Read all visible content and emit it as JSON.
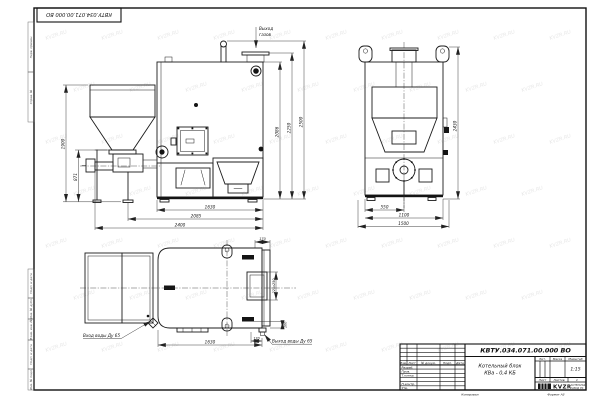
{
  "page": {
    "watermark": "KVZR.RU"
  },
  "corner_stamp": {
    "doc_number": "КВТУ.034.071.00.000 ВО"
  },
  "margin_labels": [
    "Перв. примен.",
    "Справ. №",
    "Подп. и дата",
    "Инв. № дубл.",
    "Взам. инв. №",
    "Подп. и дата",
    "Инв. № подл."
  ],
  "title_block": {
    "doc_number": "КВТУ.034.071.00.000 ВО",
    "name_line1": "Котельный блок",
    "name_line2": "КВа - 0,4 КБ",
    "col_izm": "Изм.",
    "col_list": "Лист",
    "col_doc": "№ докум.",
    "col_podp": "Подп.",
    "col_data": "Дата",
    "row_razrab": "Разраб.",
    "row_prov": "Пров.",
    "row_tkontr": "Т.контр.",
    "row_nkontr": "Н.контр.",
    "row_utv": "Утв.",
    "lit_label": "Лит.",
    "mass_label": "Масса",
    "scale_label": "Масштаб",
    "scale_value": "1:15",
    "sheet_label": "Лист",
    "sheets_label": "Листов",
    "sheets_value": "1",
    "logo_text": "KVZR",
    "logo_line1": "КОТЕЛЬНЫЙ",
    "logo_line2": "ЗАВОД РФ",
    "copied_label": "Копировал",
    "format_label": "Формат А3"
  },
  "front_view": {
    "gas_line1": "Выход",
    "gas_line2": "газов",
    "dims": {
      "left_outer": "1900",
      "left_inner": "871",
      "right_inner": "2086",
      "right_mid": "2250",
      "right_outer": "2500",
      "bottom_inner": "1630",
      "bottom_mid": "2085",
      "bottom_outer": "2400"
    }
  },
  "side_view": {
    "dims": {
      "height": "2430",
      "bottom_inner": "550",
      "bottom_mid": "1100",
      "bottom_outer": "1500"
    }
  },
  "top_view": {
    "inlet_label": "Вход воды Ду 65",
    "outlet_label": "Выход воды Ду 65",
    "dims": {
      "length": "1630",
      "stub_offset": "170",
      "door": "225x250",
      "right_small": "100",
      "top_right": "170"
    }
  }
}
